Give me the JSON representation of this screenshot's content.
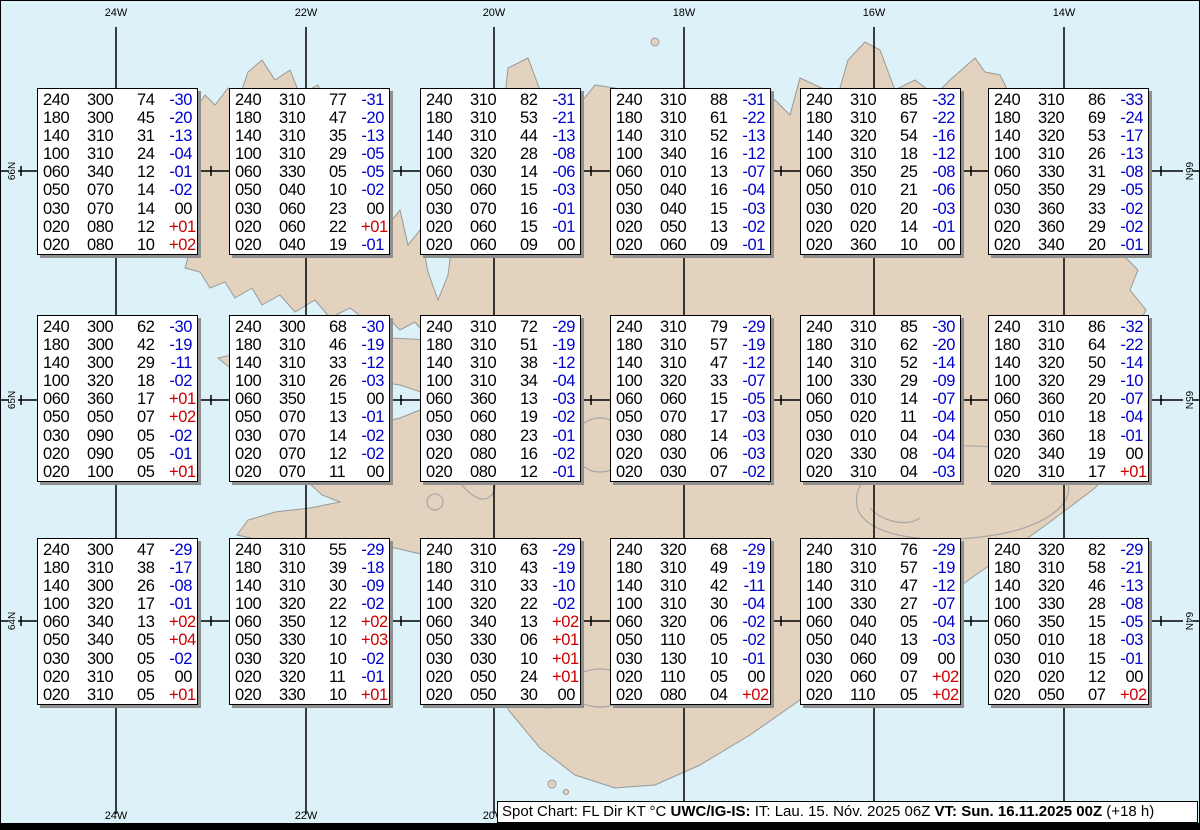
{
  "colors": {
    "sea": "#ddf2f8",
    "land": "#e2d2be",
    "coast": "#999999",
    "glacier_outline": "#a8a8a8",
    "grid_line": "#000000",
    "temp_negative": "#0000cd",
    "temp_positive": "#cc0000",
    "box_text": "#000000"
  },
  "grid": {
    "meridians": [
      {
        "label": "24W",
        "x": 116
      },
      {
        "label": "22W",
        "x": 306
      },
      {
        "label": "20W",
        "x": 494
      },
      {
        "label": "18W",
        "x": 684
      },
      {
        "label": "16W",
        "x": 874
      },
      {
        "label": "14W",
        "x": 1064
      }
    ],
    "parallels": [
      {
        "label": "66N",
        "y": 171
      },
      {
        "label": "65N",
        "y": 400
      },
      {
        "label": "64N",
        "y": 621
      }
    ],
    "tick_xs": [
      21,
      211,
      401,
      591,
      781,
      971,
      1161
    ]
  },
  "columns_legend": [
    "FL",
    "Dir",
    "KT",
    "°C"
  ],
  "boxes": [
    {
      "rows": [
        [
          "240",
          "300",
          "74",
          "-30"
        ],
        [
          "180",
          "300",
          "45",
          "-20"
        ],
        [
          "140",
          "310",
          "31",
          "-13"
        ],
        [
          "100",
          "310",
          "24",
          "-04"
        ],
        [
          "060",
          "340",
          "12",
          "-01"
        ],
        [
          "050",
          "070",
          "14",
          "-02"
        ],
        [
          "030",
          "070",
          "14",
          "00"
        ],
        [
          "020",
          "080",
          "12",
          "+01"
        ],
        [
          "020",
          "080",
          "10",
          "+02"
        ]
      ]
    },
    {
      "rows": [
        [
          "240",
          "310",
          "77",
          "-31"
        ],
        [
          "180",
          "310",
          "47",
          "-20"
        ],
        [
          "140",
          "310",
          "35",
          "-13"
        ],
        [
          "100",
          "310",
          "29",
          "-05"
        ],
        [
          "060",
          "330",
          "05",
          "-05"
        ],
        [
          "050",
          "040",
          "10",
          "-02"
        ],
        [
          "030",
          "060",
          "23",
          "00"
        ],
        [
          "020",
          "060",
          "22",
          "+01"
        ],
        [
          "020",
          "040",
          "19",
          "-01"
        ]
      ]
    },
    {
      "rows": [
        [
          "240",
          "310",
          "82",
          "-31"
        ],
        [
          "180",
          "310",
          "53",
          "-21"
        ],
        [
          "140",
          "310",
          "44",
          "-13"
        ],
        [
          "100",
          "320",
          "28",
          "-08"
        ],
        [
          "060",
          "030",
          "14",
          "-06"
        ],
        [
          "050",
          "060",
          "15",
          "-03"
        ],
        [
          "030",
          "070",
          "16",
          "-01"
        ],
        [
          "020",
          "060",
          "15",
          "-01"
        ],
        [
          "020",
          "060",
          "09",
          "00"
        ]
      ]
    },
    {
      "rows": [
        [
          "240",
          "310",
          "88",
          "-31"
        ],
        [
          "180",
          "310",
          "61",
          "-22"
        ],
        [
          "140",
          "310",
          "52",
          "-13"
        ],
        [
          "100",
          "340",
          "16",
          "-12"
        ],
        [
          "060",
          "010",
          "13",
          "-07"
        ],
        [
          "050",
          "040",
          "16",
          "-04"
        ],
        [
          "030",
          "040",
          "15",
          "-03"
        ],
        [
          "020",
          "050",
          "13",
          "-02"
        ],
        [
          "020",
          "060",
          "09",
          "-01"
        ]
      ]
    },
    {
      "rows": [
        [
          "240",
          "310",
          "85",
          "-32"
        ],
        [
          "180",
          "310",
          "67",
          "-22"
        ],
        [
          "140",
          "320",
          "54",
          "-16"
        ],
        [
          "100",
          "310",
          "18",
          "-12"
        ],
        [
          "060",
          "350",
          "25",
          "-08"
        ],
        [
          "050",
          "010",
          "21",
          "-06"
        ],
        [
          "030",
          "020",
          "20",
          "-03"
        ],
        [
          "020",
          "020",
          "14",
          "-01"
        ],
        [
          "020",
          "360",
          "10",
          "00"
        ]
      ]
    },
    {
      "rows": [
        [
          "240",
          "310",
          "86",
          "-33"
        ],
        [
          "180",
          "320",
          "69",
          "-24"
        ],
        [
          "140",
          "320",
          "53",
          "-17"
        ],
        [
          "100",
          "310",
          "26",
          "-13"
        ],
        [
          "060",
          "330",
          "31",
          "-08"
        ],
        [
          "050",
          "350",
          "29",
          "-05"
        ],
        [
          "030",
          "360",
          "33",
          "-02"
        ],
        [
          "020",
          "360",
          "29",
          "-02"
        ],
        [
          "020",
          "340",
          "20",
          "-01"
        ]
      ]
    },
    {
      "rows": [
        [
          "240",
          "300",
          "62",
          "-30"
        ],
        [
          "180",
          "300",
          "42",
          "-19"
        ],
        [
          "140",
          "300",
          "29",
          "-11"
        ],
        [
          "100",
          "320",
          "18",
          "-02"
        ],
        [
          "060",
          "360",
          "17",
          "+01"
        ],
        [
          "050",
          "050",
          "07",
          "+02"
        ],
        [
          "030",
          "090",
          "05",
          "-02"
        ],
        [
          "020",
          "090",
          "05",
          "-01"
        ],
        [
          "020",
          "100",
          "05",
          "+01"
        ]
      ]
    },
    {
      "rows": [
        [
          "240",
          "300",
          "68",
          "-30"
        ],
        [
          "180",
          "310",
          "46",
          "-19"
        ],
        [
          "140",
          "310",
          "33",
          "-12"
        ],
        [
          "100",
          "310",
          "26",
          "-03"
        ],
        [
          "060",
          "350",
          "15",
          "00"
        ],
        [
          "050",
          "070",
          "13",
          "-01"
        ],
        [
          "030",
          "070",
          "14",
          "-02"
        ],
        [
          "020",
          "070",
          "12",
          "-02"
        ],
        [
          "020",
          "070",
          "11",
          "00"
        ]
      ]
    },
    {
      "rows": [
        [
          "240",
          "310",
          "72",
          "-29"
        ],
        [
          "180",
          "310",
          "51",
          "-19"
        ],
        [
          "140",
          "310",
          "38",
          "-12"
        ],
        [
          "100",
          "310",
          "34",
          "-04"
        ],
        [
          "060",
          "360",
          "13",
          "-03"
        ],
        [
          "050",
          "060",
          "19",
          "-02"
        ],
        [
          "030",
          "080",
          "23",
          "-01"
        ],
        [
          "020",
          "080",
          "16",
          "-02"
        ],
        [
          "020",
          "080",
          "12",
          "-01"
        ]
      ]
    },
    {
      "rows": [
        [
          "240",
          "310",
          "79",
          "-29"
        ],
        [
          "180",
          "310",
          "57",
          "-19"
        ],
        [
          "140",
          "310",
          "47",
          "-12"
        ],
        [
          "100",
          "320",
          "33",
          "-07"
        ],
        [
          "060",
          "060",
          "15",
          "-05"
        ],
        [
          "050",
          "070",
          "17",
          "-03"
        ],
        [
          "030",
          "080",
          "14",
          "-03"
        ],
        [
          "020",
          "030",
          "06",
          "-03"
        ],
        [
          "020",
          "030",
          "07",
          "-02"
        ]
      ]
    },
    {
      "rows": [
        [
          "240",
          "310",
          "85",
          "-30"
        ],
        [
          "180",
          "310",
          "62",
          "-20"
        ],
        [
          "140",
          "310",
          "52",
          "-14"
        ],
        [
          "100",
          "330",
          "29",
          "-09"
        ],
        [
          "060",
          "010",
          "14",
          "-07"
        ],
        [
          "050",
          "020",
          "11",
          "-04"
        ],
        [
          "030",
          "010",
          "04",
          "-04"
        ],
        [
          "020",
          "330",
          "08",
          "-04"
        ],
        [
          "020",
          "310",
          "04",
          "-03"
        ]
      ]
    },
    {
      "rows": [
        [
          "240",
          "310",
          "86",
          "-32"
        ],
        [
          "180",
          "310",
          "64",
          "-22"
        ],
        [
          "140",
          "320",
          "50",
          "-14"
        ],
        [
          "100",
          "320",
          "29",
          "-10"
        ],
        [
          "060",
          "360",
          "20",
          "-07"
        ],
        [
          "050",
          "010",
          "18",
          "-04"
        ],
        [
          "030",
          "360",
          "18",
          "-01"
        ],
        [
          "020",
          "340",
          "19",
          "00"
        ],
        [
          "020",
          "310",
          "17",
          "+01"
        ]
      ]
    },
    {
      "rows": [
        [
          "240",
          "300",
          "47",
          "-29"
        ],
        [
          "180",
          "310",
          "38",
          "-17"
        ],
        [
          "140",
          "300",
          "26",
          "-08"
        ],
        [
          "100",
          "320",
          "17",
          "-01"
        ],
        [
          "060",
          "340",
          "13",
          "+02"
        ],
        [
          "050",
          "340",
          "05",
          "+04"
        ],
        [
          "030",
          "300",
          "05",
          "-02"
        ],
        [
          "020",
          "310",
          "05",
          "00"
        ],
        [
          "020",
          "310",
          "05",
          "+01"
        ]
      ]
    },
    {
      "rows": [
        [
          "240",
          "310",
          "55",
          "-29"
        ],
        [
          "180",
          "310",
          "39",
          "-18"
        ],
        [
          "140",
          "310",
          "30",
          "-09"
        ],
        [
          "100",
          "320",
          "22",
          "-02"
        ],
        [
          "060",
          "350",
          "12",
          "+02"
        ],
        [
          "050",
          "330",
          "10",
          "+03"
        ],
        [
          "030",
          "320",
          "10",
          "-02"
        ],
        [
          "020",
          "320",
          "11",
          "-01"
        ],
        [
          "020",
          "330",
          "10",
          "+01"
        ]
      ]
    },
    {
      "rows": [
        [
          "240",
          "310",
          "63",
          "-29"
        ],
        [
          "180",
          "310",
          "43",
          "-19"
        ],
        [
          "140",
          "310",
          "33",
          "-10"
        ],
        [
          "100",
          "320",
          "22",
          "-02"
        ],
        [
          "060",
          "340",
          "13",
          "+02"
        ],
        [
          "050",
          "330",
          "06",
          "+01"
        ],
        [
          "030",
          "030",
          "10",
          "+01"
        ],
        [
          "020",
          "050",
          "24",
          "+01"
        ],
        [
          "020",
          "050",
          "30",
          "00"
        ]
      ]
    },
    {
      "rows": [
        [
          "240",
          "320",
          "68",
          "-29"
        ],
        [
          "180",
          "310",
          "49",
          "-19"
        ],
        [
          "140",
          "310",
          "42",
          "-11"
        ],
        [
          "100",
          "310",
          "30",
          "-04"
        ],
        [
          "060",
          "320",
          "06",
          "-02"
        ],
        [
          "050",
          "110",
          "05",
          "-02"
        ],
        [
          "030",
          "130",
          "10",
          "-01"
        ],
        [
          "020",
          "110",
          "05",
          "00"
        ],
        [
          "020",
          "080",
          "04",
          "+02"
        ]
      ]
    },
    {
      "rows": [
        [
          "240",
          "310",
          "76",
          "-29"
        ],
        [
          "180",
          "310",
          "57",
          "-19"
        ],
        [
          "140",
          "310",
          "47",
          "-12"
        ],
        [
          "100",
          "330",
          "27",
          "-07"
        ],
        [
          "060",
          "040",
          "05",
          "-04"
        ],
        [
          "050",
          "040",
          "13",
          "-03"
        ],
        [
          "030",
          "060",
          "09",
          "00"
        ],
        [
          "020",
          "060",
          "07",
          "+02"
        ],
        [
          "020",
          "110",
          "05",
          "+02"
        ]
      ]
    },
    {
      "rows": [
        [
          "240",
          "320",
          "82",
          "-29"
        ],
        [
          "180",
          "310",
          "58",
          "-21"
        ],
        [
          "140",
          "320",
          "46",
          "-13"
        ],
        [
          "100",
          "330",
          "28",
          "-08"
        ],
        [
          "060",
          "350",
          "15",
          "-05"
        ],
        [
          "050",
          "010",
          "18",
          "-03"
        ],
        [
          "030",
          "010",
          "15",
          "-01"
        ],
        [
          "020",
          "020",
          "12",
          "00"
        ],
        [
          "020",
          "050",
          "07",
          "+02"
        ]
      ]
    }
  ],
  "footer": {
    "segments": [
      {
        "text": "Spot Chart: FL Dir KT °C ",
        "bold": false
      },
      {
        "text": "UWC/IG-IS:",
        "bold": true
      },
      {
        "text": " IT: Lau. 15. Nóv. 2025 06Z ",
        "bold": false
      },
      {
        "text": "VT: Sun. 16.11.2025 00Z",
        "bold": true
      },
      {
        "text": " (+18 h)",
        "bold": false
      }
    ]
  }
}
